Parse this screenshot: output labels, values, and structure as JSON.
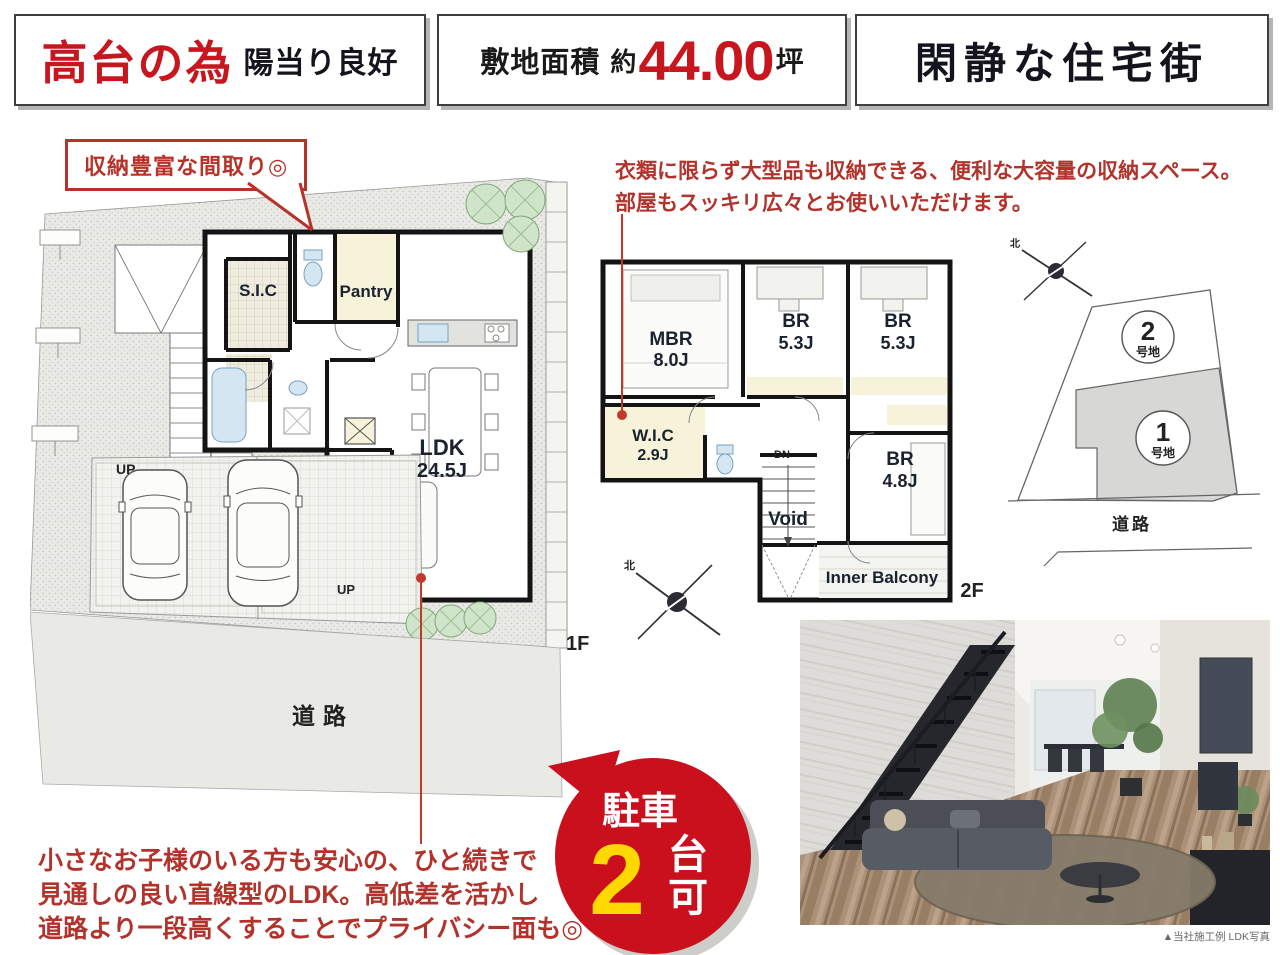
{
  "header": {
    "box1": {
      "em": "高台の為",
      "rest": "陽当り良好"
    },
    "box2": {
      "label": "敷地面積",
      "approx": "約",
      "value": "44.00",
      "unit": "坪"
    },
    "box3": {
      "text": "閑静な住宅街"
    }
  },
  "callout": {
    "text": "収納豊富な間取り◎"
  },
  "notes": {
    "storage": {
      "line1": "衣類に限らず大型品も収納できる、便利な大容量の収納スペース。",
      "line2": "部屋もスッキリ広々とお使いいただけます。"
    },
    "ldk": {
      "line1": "小さなお子様のいる方も安心の、ひと続きで",
      "line2": "見通しの良い直線型のLDK。高低差を活かし",
      "line3": "道路より一段高くすることでプライバシー面も◎"
    }
  },
  "badge": {
    "word": "駐車",
    "count": "2",
    "suffix_top": "台",
    "suffix_bottom": "可"
  },
  "floor1": {
    "floor_label": "1F",
    "sic": "S.I.C",
    "pantry": "Pantry",
    "ldk": "LDK",
    "ldk_size": "24.5J",
    "up_garage": "UP",
    "up_stairs": "UP",
    "road": "道路"
  },
  "floor2": {
    "floor_label": "2F",
    "mbr": "MBR",
    "mbr_size": "8.0J",
    "br1": "BR",
    "br1_size": "5.3J",
    "br2": "BR",
    "br2_size": "5.3J",
    "wic": "W.I.C",
    "wic_size": "2.9J",
    "br3": "BR",
    "br3_size": "4.8J",
    "void": "Void",
    "balcony": "Inner Balcony",
    "dn": "DN"
  },
  "siteplan": {
    "lot2": {
      "num": "2",
      "label": "号地"
    },
    "lot1": {
      "num": "1",
      "label": "号地"
    },
    "road": "道路"
  },
  "compass": {
    "north": "北"
  },
  "photo": {
    "caption": "▲当社施工例 LDK写真"
  },
  "colors": {
    "accent_red": "#c8161e",
    "badge_red": "#c9101c",
    "badge_yellow": "#ffd800",
    "wall_black": "#141414",
    "site_gray": "#e9e9e6",
    "lot_gray": "#d7d7d5",
    "tatami_yellow": "#f6f3da",
    "fixture_blue": "#d4e6f2",
    "tree_green": "#cfe4c8"
  }
}
